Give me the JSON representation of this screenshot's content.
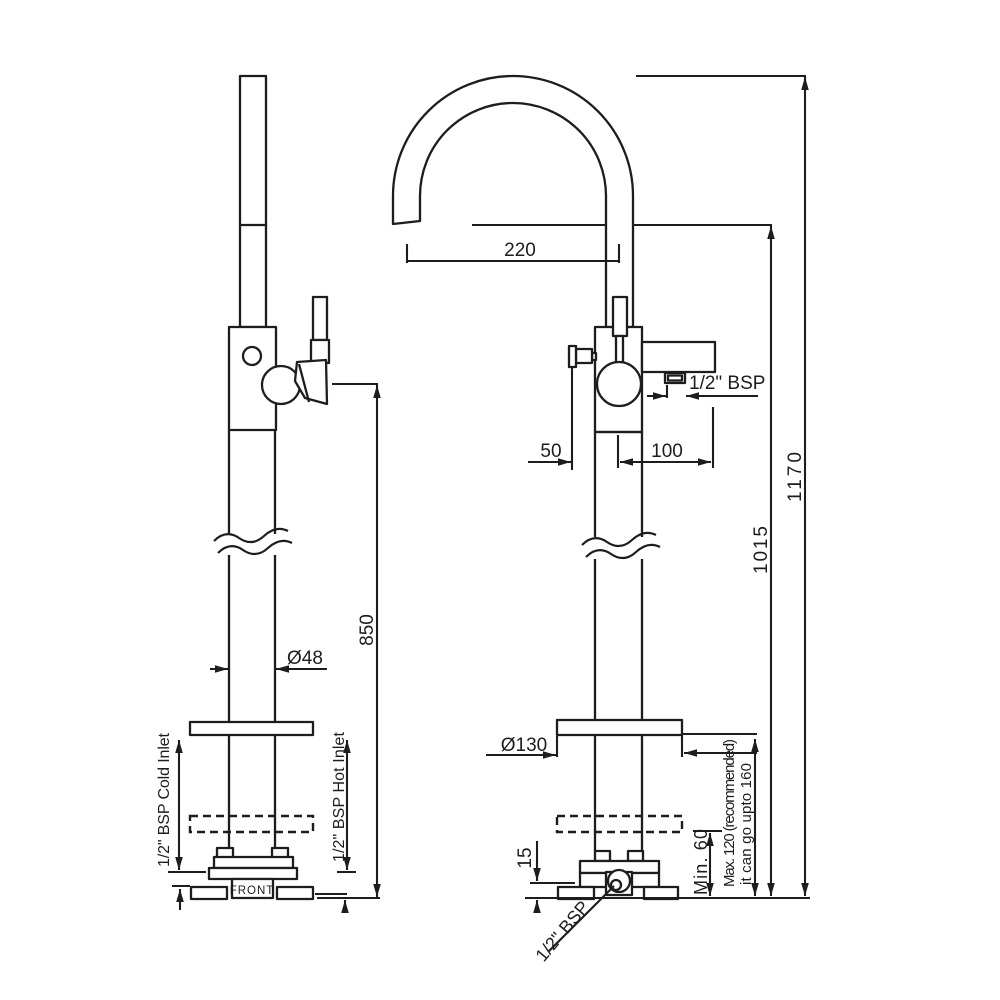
{
  "views": {
    "side": {
      "front_label": "FRONT",
      "cold_inlet_label": "1/2\" BSP Cold Inlet",
      "hot_inlet_label": "1/2\" BSP Hot Inlet",
      "pipe_diameter": "Ø48",
      "height_to_outlet": "850"
    },
    "front": {
      "spout_reach": "220",
      "overall_height": "1170",
      "spout_outlet_height": "1015",
      "handle_offset": "50",
      "spout_offset": "100",
      "outlet_connection": "1/2\" BSP",
      "flange_diameter": "Ø130",
      "base_plate_height": "15",
      "min_depth": "Min. 60",
      "max_depth_line1": "Max. 120 (recommended)",
      "max_depth_line2": "it can go upto 160",
      "base_connection": "1/2\" BSP"
    }
  },
  "colors": {
    "line": "#1d1d1d",
    "background": "#ffffff"
  }
}
